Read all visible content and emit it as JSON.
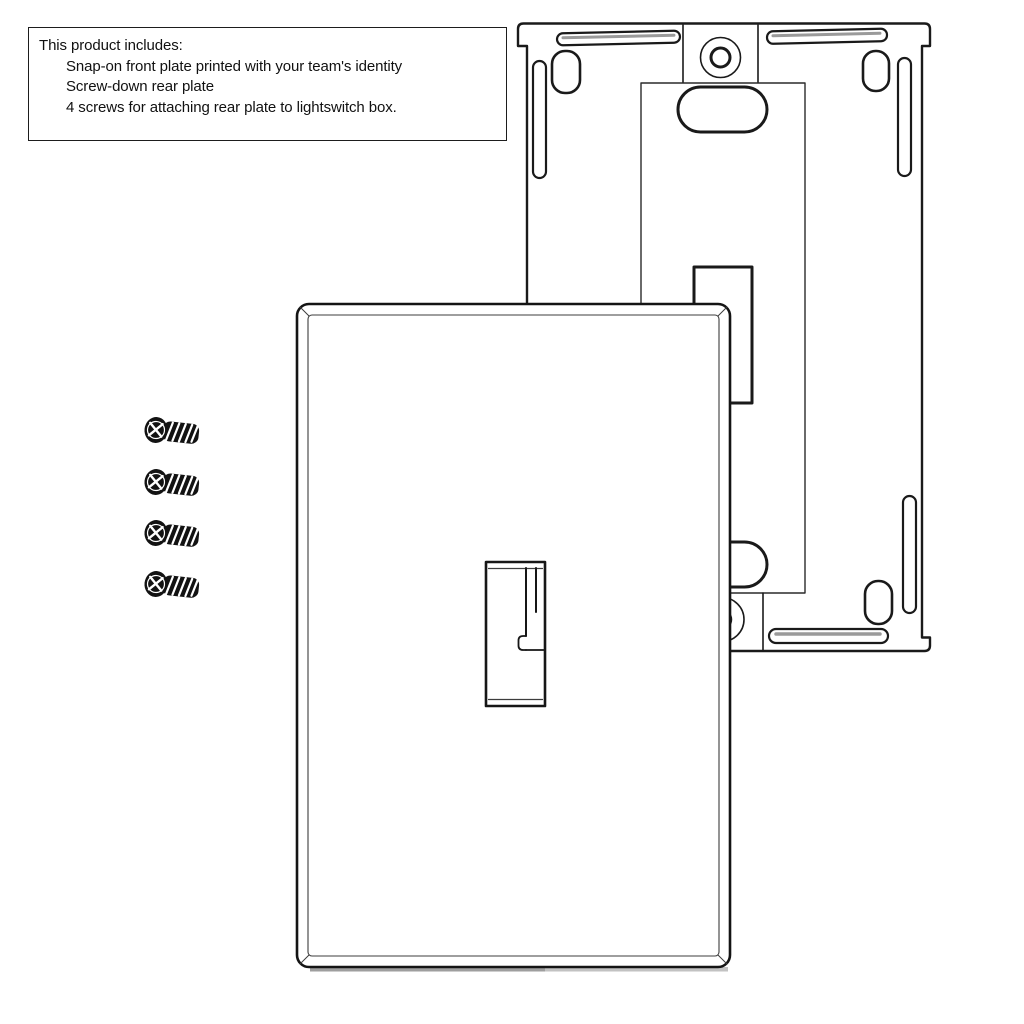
{
  "info_box": {
    "title": "This product includes:",
    "items": [
      "Snap-on front plate printed with your team's identity",
      "Screw-down rear plate",
      "4 screws for attaching rear plate to lightswitch box."
    ]
  },
  "parts": {
    "front_plate_icon": "snap-on-front-plate",
    "rear_plate_icon": "screw-down-rear-plate",
    "screw_icon": "mounting-screw",
    "screw_count": 4
  },
  "colors": {
    "line": "#1a1a1a",
    "background": "#ffffff",
    "shadow": "#b5b5b5"
  }
}
